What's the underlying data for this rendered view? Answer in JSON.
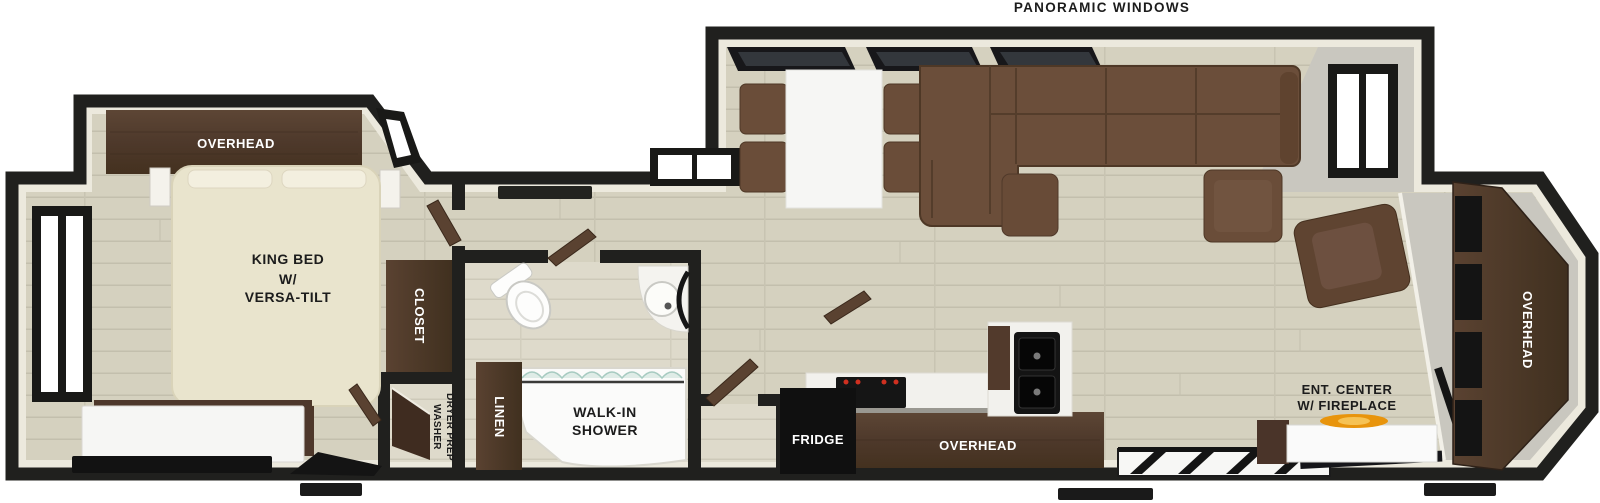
{
  "labels": {
    "panoramic_windows": "PANORAMIC WINDOWS",
    "bedroom_overhead": "OVERHEAD",
    "king_bed_line1": "KING BED",
    "king_bed_line2": "W/",
    "king_bed_line3": "VERSA-TILT",
    "closet": "CLOSET",
    "washer_line1": "WASHER",
    "washer_line2": "DRYER PREP",
    "linen": "LINEN",
    "shower_line1": "WALK-IN",
    "shower_line2": "SHOWER",
    "fridge": "FRIDGE",
    "kitchen_overhead": "OVERHEAD",
    "ent_center_line1": "ENT. CENTER",
    "ent_center_line2": "W/ FIREPLACE",
    "rear_overhead": "OVERHEAD"
  },
  "colors": {
    "wall": "#20201e",
    "inner_wall": "#ece9dd",
    "floor": "#d5d1bf",
    "floor_line": "#c3bfad",
    "bath_floor": "#dedacb",
    "gray_face": "#c9c7bf",
    "cabinet_wood": "#523c2d",
    "sofa_brown": "#6b4e3a",
    "bed_cream": "#e9e4cd",
    "appliance_black": "#121212",
    "burner_red": "#d03020",
    "flame_orange": "#e8940c",
    "white_furniture": "#f6f6f4"
  }
}
